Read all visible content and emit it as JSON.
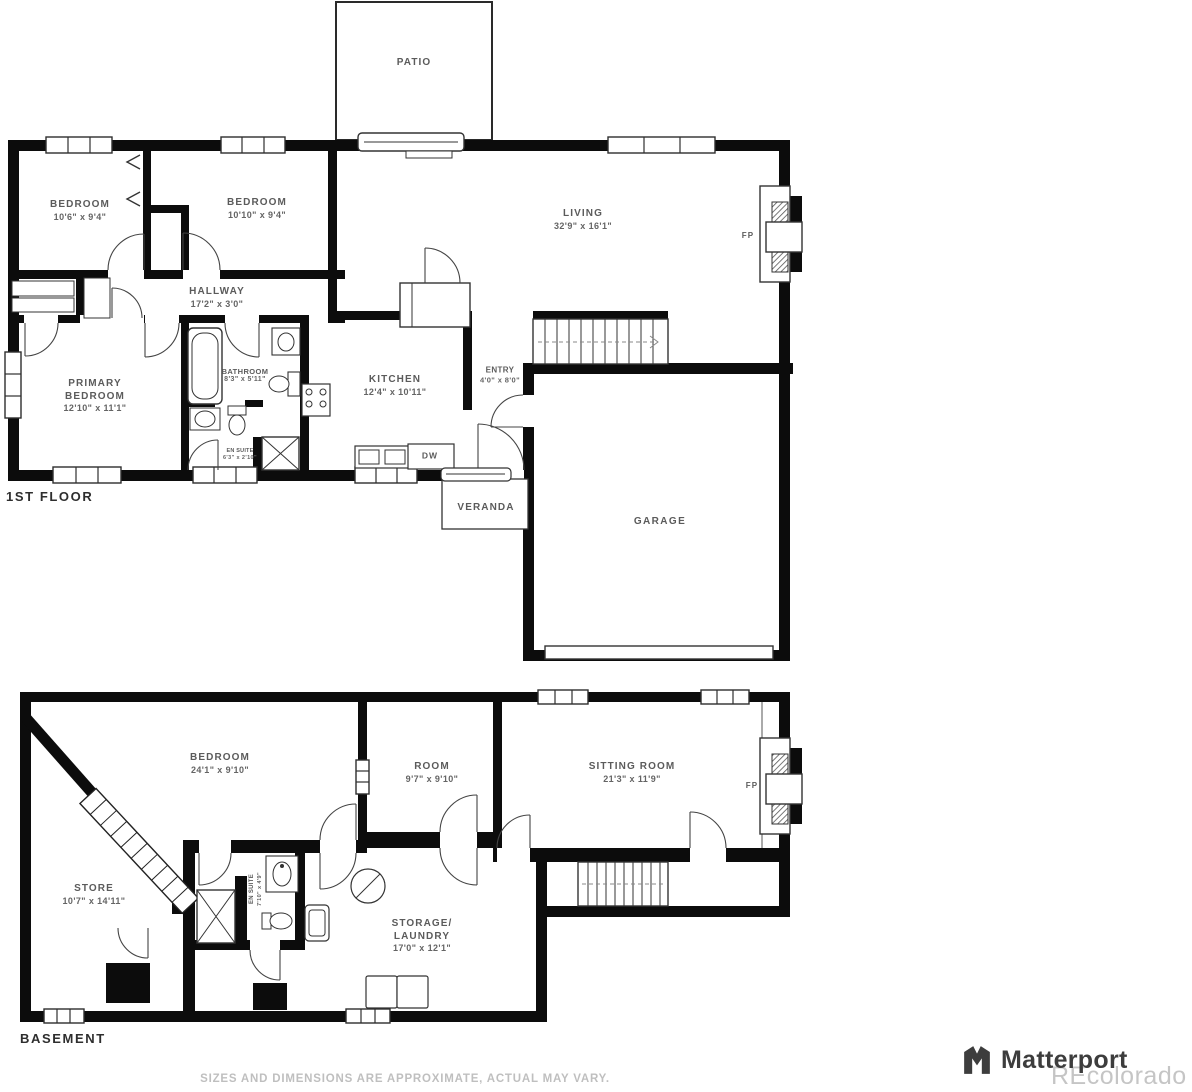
{
  "floors": {
    "first": {
      "title": "1ST FLOOR",
      "patio": "PATIO",
      "bedroom1": {
        "name": "BEDROOM",
        "dims": "10'6\" x 9'4\""
      },
      "bedroom2": {
        "name": "BEDROOM",
        "dims": "10'10\" x 9'4\""
      },
      "living": {
        "name": "LIVING",
        "dims": "32'9\" x 16'1\""
      },
      "hallway": {
        "name": "HALLWAY",
        "dims": "17'2\" x 3'0\""
      },
      "primary": {
        "line1": "PRIMARY",
        "line2": "BEDROOM",
        "dims": "12'10\" x 11'1\""
      },
      "bathroom": {
        "name": "BATHROOM",
        "dims": "8'3\" x 5'11\""
      },
      "kitchen": {
        "name": "KITCHEN",
        "dims": "12'4\" x 10'11\""
      },
      "entry": {
        "name": "ENTRY",
        "dims": "4'0\" x 8'0\""
      },
      "ensuite": {
        "name": "EN SUITE",
        "dims": "6'3\" x 2'10\""
      },
      "dishwasher": "DW",
      "veranda": "VERANDA",
      "garage": "GARAGE",
      "fireplace": "FP"
    },
    "basement": {
      "title": "BASEMENT",
      "bedroom": {
        "name": "BEDROOM",
        "dims": "24'1\" x 9'10\""
      },
      "room": {
        "name": "ROOM",
        "dims": "9'7\" x 9'10\""
      },
      "sitting": {
        "name": "SITTING ROOM",
        "dims": "21'3\" x 11'9\""
      },
      "store": {
        "name": "STORE",
        "dims": "10'7\" x 14'11\""
      },
      "ensuite": {
        "name": "EN SUITE",
        "dims": "7'10\" x 4'9\""
      },
      "storage": {
        "line1": "STORAGE/",
        "line2": "LAUNDRY",
        "dims": "17'0\" x 12'1\""
      },
      "fireplace": "FP"
    }
  },
  "footer": {
    "disclaimer": "SIZES AND DIMENSIONS ARE APPROXIMATE, ACTUAL MAY VARY.",
    "brand": "Matterport",
    "watermark": "REcolorado"
  }
}
